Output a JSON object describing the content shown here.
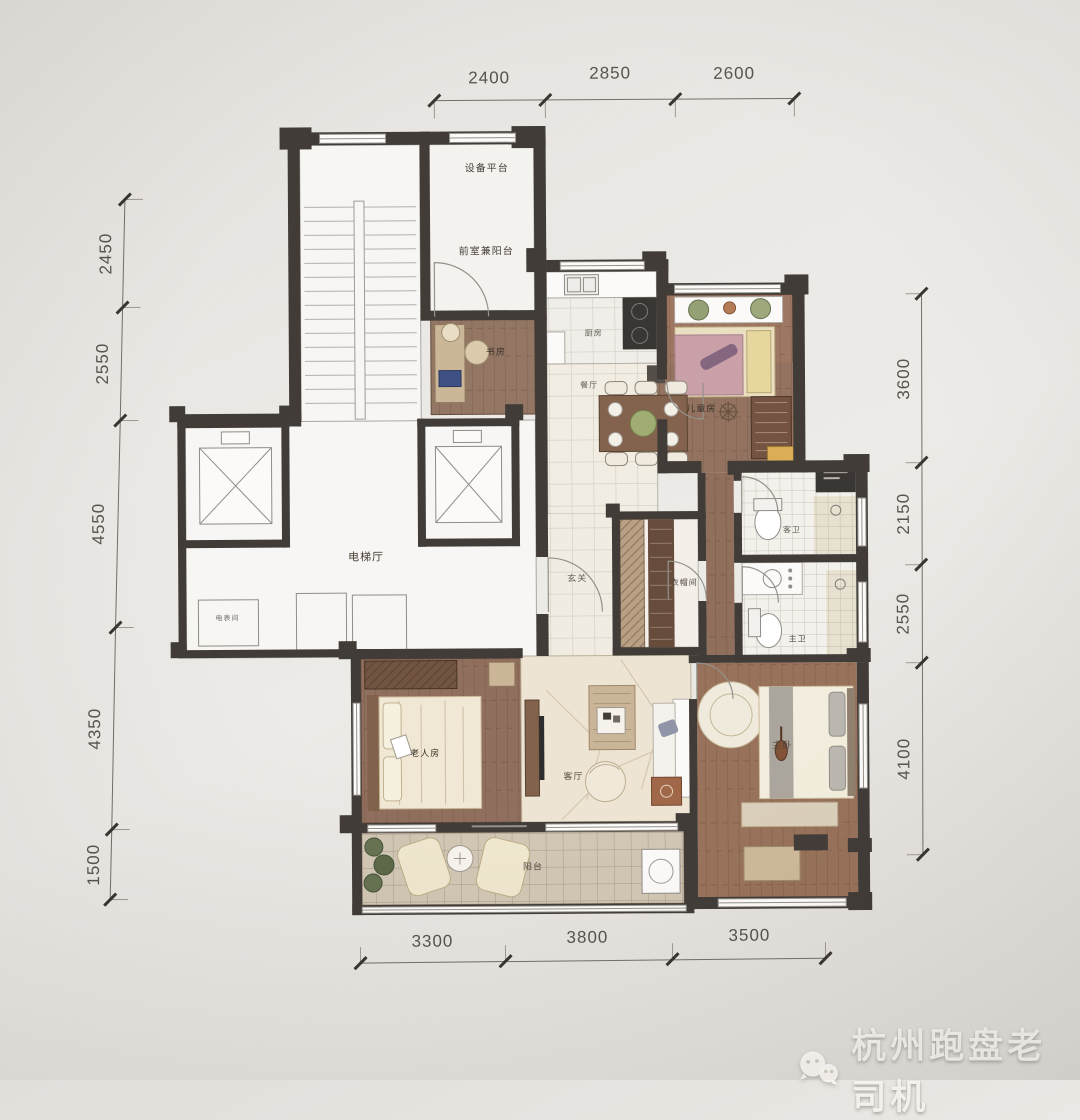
{
  "watermark": {
    "text": "杭州跑盘老司机",
    "icon": "wechat-icon"
  },
  "dimensions": {
    "top": [
      "2400",
      "2850",
      "2600"
    ],
    "left": [
      "2450",
      "2550",
      "4550",
      "4350",
      "1500"
    ],
    "right": [
      "3600",
      "2150",
      "2550",
      "4100"
    ],
    "bottom": [
      "3300",
      "3800",
      "3500"
    ]
  },
  "rooms": {
    "equipment_platform": "设备平台",
    "front_room_balcony": "前室兼阳台",
    "elevator_hall": "电梯厅",
    "meter_room": "电表间",
    "study": "书房",
    "kitchen": "厨房",
    "dining": "餐厅",
    "kids_room": "儿童房",
    "foyer": "玄关",
    "cloakroom": "衣帽间",
    "guest_bath": "客卫",
    "master_bath": "主卫",
    "elder_room": "老人房",
    "living_room": "客厅",
    "master_bedroom": "主卧",
    "balcony": "阳台"
  },
  "colors": {
    "wall": "#38322e",
    "wood": "#8d6c58",
    "tile": "#f0ede5",
    "balcony_tile": "#cfc3b0",
    "stone": "#ece3d1",
    "dim_text": "#4f4b45"
  }
}
